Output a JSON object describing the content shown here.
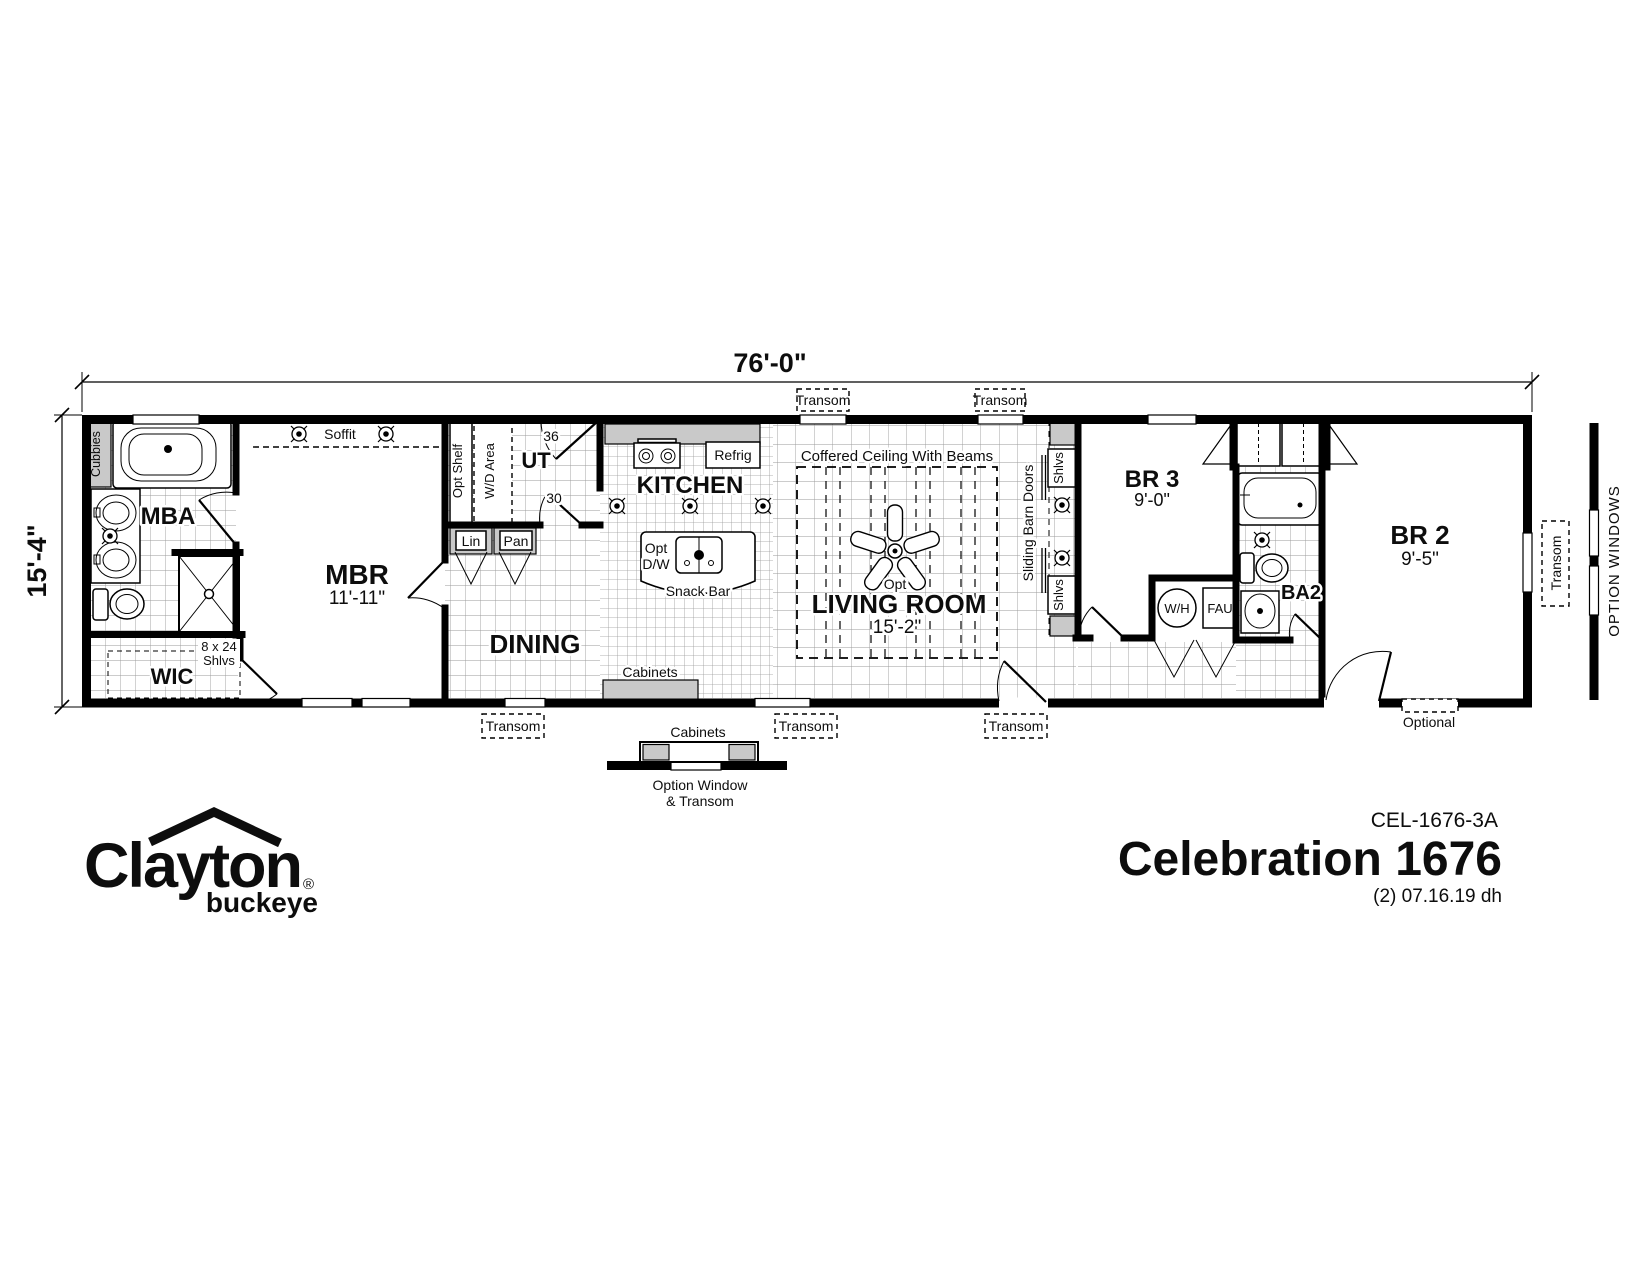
{
  "meta": {
    "model_code": "CEL-1676-3A",
    "model_name": "Celebration 1676",
    "revision": "(2) 07.16.19 dh"
  },
  "logo": {
    "brand": "Clayton",
    "sub_brand": "buckeye",
    "registered": "®"
  },
  "dimensions": {
    "overall_width": "76'-0\"",
    "overall_depth": "15'-4\""
  },
  "rooms": {
    "mba": {
      "label": "MBA"
    },
    "mbr": {
      "label": "MBR",
      "size": "11'-11\""
    },
    "wic": {
      "label": "WIC"
    },
    "ut": {
      "label": "UT"
    },
    "kitchen": {
      "label": "KITCHEN"
    },
    "dining": {
      "label": "DINING"
    },
    "living_room": {
      "label": "LIVING ROOM",
      "size": "15'-2\""
    },
    "br3": {
      "label": "BR 3",
      "size": "9'-0\""
    },
    "ba2": {
      "label": "BA2"
    },
    "br2": {
      "label": "BR 2",
      "size": "9'-5\""
    }
  },
  "labels": {
    "cubbies": "Cubbies",
    "soffit": "Soffit",
    "opt_shelf": "Opt Shelf",
    "wd_area": "W/D Area",
    "door_36": "36",
    "door_30": "30",
    "lin": "Lin",
    "pan": "Pan",
    "refrig": "Refrig",
    "opt": "Opt",
    "dw": "D/W",
    "snack_bar": "Snack Bar",
    "coffered_ceiling": "Coffered Ceiling With Beams",
    "sliding_barn_doors": "Sliding Barn Doors",
    "shlvs": "Shlvs",
    "shelf_8x24": "8 x 24",
    "water_heater": "W/H",
    "fau": "FAU",
    "cabinets": "Cabinets",
    "transom": "Transom",
    "optional": "Optional",
    "option_windows": "OPTION WINDOWS",
    "option_window": "Option Window",
    "and_transom": "& Transom"
  },
  "colors": {
    "wall": "#000000",
    "fixture_gray": "#c9c9c9",
    "grid": "#9a9a9a",
    "background": "#ffffff"
  }
}
